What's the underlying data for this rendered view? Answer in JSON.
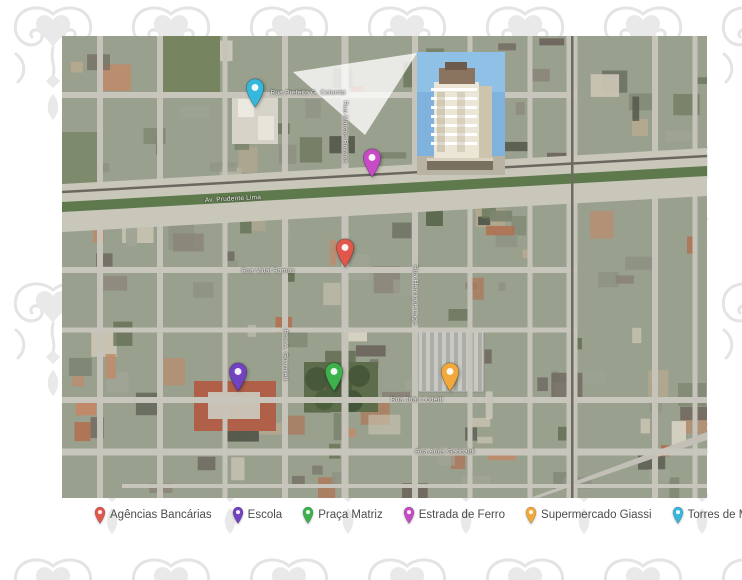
{
  "page": {
    "background_color": "#ffffff",
    "pattern_color": "#e6e6e6"
  },
  "map": {
    "type": "satellite-aerial-view",
    "street_labels": [
      {
        "text": "Rua Prefeito G. Colombi",
        "x": 246,
        "y": 57,
        "rotation": 0
      },
      {
        "text": "Rua Marcos Rovaris",
        "x": 283,
        "y": 96,
        "rotation": 90
      },
      {
        "text": "Av. Prudente Lima",
        "x": 171,
        "y": 163,
        "rotation": -3
      },
      {
        "text": "Rua Vidal Ramos",
        "x": 206,
        "y": 235,
        "rotation": 0
      },
      {
        "text": "Rua Henrique Lage",
        "x": 353,
        "y": 259,
        "rotation": 90
      },
      {
        "text": "Rua A. Guarnieri",
        "x": 223,
        "y": 319,
        "rotation": 90
      },
      {
        "text": "Rua João Lodetti",
        "x": 355,
        "y": 364,
        "rotation": 0
      },
      {
        "text": "Rua Anita Garibaldi",
        "x": 383,
        "y": 416,
        "rotation": 0
      }
    ],
    "pins": [
      {
        "id": "torres-de-miro",
        "label": "Torres de Miró",
        "color": "#35b8dc",
        "x": 193,
        "y": 72
      },
      {
        "id": "estrada-de-ferro",
        "label": "Estrada de Ferro",
        "color": "#c74bc7",
        "x": 310,
        "y": 142
      },
      {
        "id": "agencias-bancarias",
        "label": "Agências Bancárias",
        "color": "#e2574c",
        "x": 283,
        "y": 232
      },
      {
        "id": "escola",
        "label": "Escola",
        "color": "#7243c0",
        "x": 176,
        "y": 356
      },
      {
        "id": "praca-matriz",
        "label": "Praça Matriz",
        "color": "#3cb14c",
        "x": 272,
        "y": 356
      },
      {
        "id": "supermercado-giassi",
        "label": "Supermercado Giassi",
        "color": "#f2a93b",
        "x": 388,
        "y": 356
      }
    ],
    "inset": {
      "description": "building-rendering-callout"
    }
  },
  "legend": {
    "items": [
      {
        "id": "agencias-bancarias",
        "label": "Agências Bancárias",
        "color": "#e2574c"
      },
      {
        "id": "escola",
        "label": "Escola",
        "color": "#7243c0"
      },
      {
        "id": "praca-matriz",
        "label": "Praça Matriz",
        "color": "#3cb14c"
      },
      {
        "id": "estrada-de-ferro",
        "label": "Estrada de Ferro",
        "color": "#c74bc7"
      },
      {
        "id": "supermercado-giassi",
        "label": "Supermercado Giassi",
        "color": "#f2a93b"
      },
      {
        "id": "torres-de-miro",
        "label": "Torres de Miró",
        "color": "#35b8dc"
      }
    ]
  }
}
